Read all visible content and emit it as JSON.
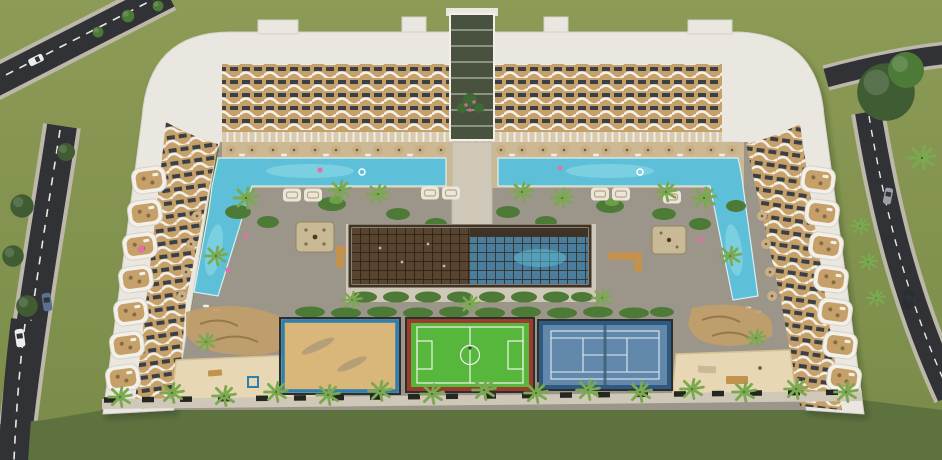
{
  "scene": {
    "setting": "Aerial 3D architectural render of a U-shaped white residential resort complex with courtyard pools, gardens, central lattice pavilion and three sports courts"
  },
  "features": {
    "courts": [
      "beach volleyball court",
      "football pitch",
      "tennis court"
    ],
    "pools": [
      "left courtyard pool with side arm",
      "right courtyard pool with side arm",
      "covered pool under pavilion"
    ],
    "vehicles": [
      "white car",
      "blue car",
      "white car",
      "grey car",
      "dark van"
    ]
  },
  "icons": {
    "palm_tree_icon": "radial fronds star",
    "tree_icon": "dark canopy disc",
    "umbrella_icon": "tan disc with dark center",
    "lounger_icon": "small white slat",
    "cabana_icon": "white rounded canopy",
    "car_icon": "rounded body with dark windshield"
  },
  "colors": {
    "grass": "#8c9b56",
    "grass_dark": "#7a8b49",
    "lawn": "#5e7240",
    "road": "#303236",
    "road_edge": "#bdb8aa",
    "road_line": "#e9e9e6",
    "roof_white": "#eae7e1",
    "roof_edge": "#d7d2c7",
    "facade_tan": "#c6a069",
    "facade_window": "#3b4046",
    "facade_white": "#f3f0ea",
    "arcade": "#d8cbb0",
    "atrium_glass": "#49523f",
    "atrium_plants": "#3f6a34",
    "atrium_flower": "#c06a95",
    "courtyard": "#9c968a",
    "deck": "#ccb993",
    "walkway": "#cfc8b8",
    "pool": "#5ec0d8",
    "pool_light": "#93dbe9",
    "pool_indoor": "#4b7e9d",
    "pool_edge": "#d9eef3",
    "umbrella": "#c9af85",
    "umbrella_dark": "#6f5b3a",
    "lounger": "#f2efe7",
    "cabana": "#ebe6db",
    "cabana_edge": "#bca77e",
    "green": "#4e7a38",
    "green_light": "#6f9e4a",
    "palm": "#7aa94f",
    "tree": "#3f5c33",
    "pergola": "#59452f",
    "pergola_grid": "#2c241b",
    "pergola_frame": "#3f3326",
    "platform": "#c9ba96",
    "platform_edge": "#93835f",
    "wood": "#c3924f",
    "furniture": "#856a47",
    "firepit": "#54361f",
    "dune": "#c09e69",
    "dune_line": "#97784c",
    "sand_play": "#e7d7b4",
    "sand_edge": "#d5c190",
    "court_sand": "#d9b679",
    "court_sand_border": "#2f7fad",
    "pitch": "#57b63c",
    "pitch_border": "#9c3a2e",
    "pitch_line": "#eef6ea",
    "tennis": "#6289ac",
    "tennis_border": "#2e5a81",
    "tennis_line": "#e2ebf1",
    "tennis_net": "#3c5a74",
    "fence": "#2c2e2f",
    "planter": "#242720",
    "float_pink": "#e070a5",
    "float_white": "#ffffff",
    "car_white": "#eeeeec",
    "car_blue": "#5c7190",
    "car_dark": "#2b2d31",
    "car_gray": "#9aa0a5",
    "glass": "#2f3439",
    "court_shadow": "#70767b"
  }
}
